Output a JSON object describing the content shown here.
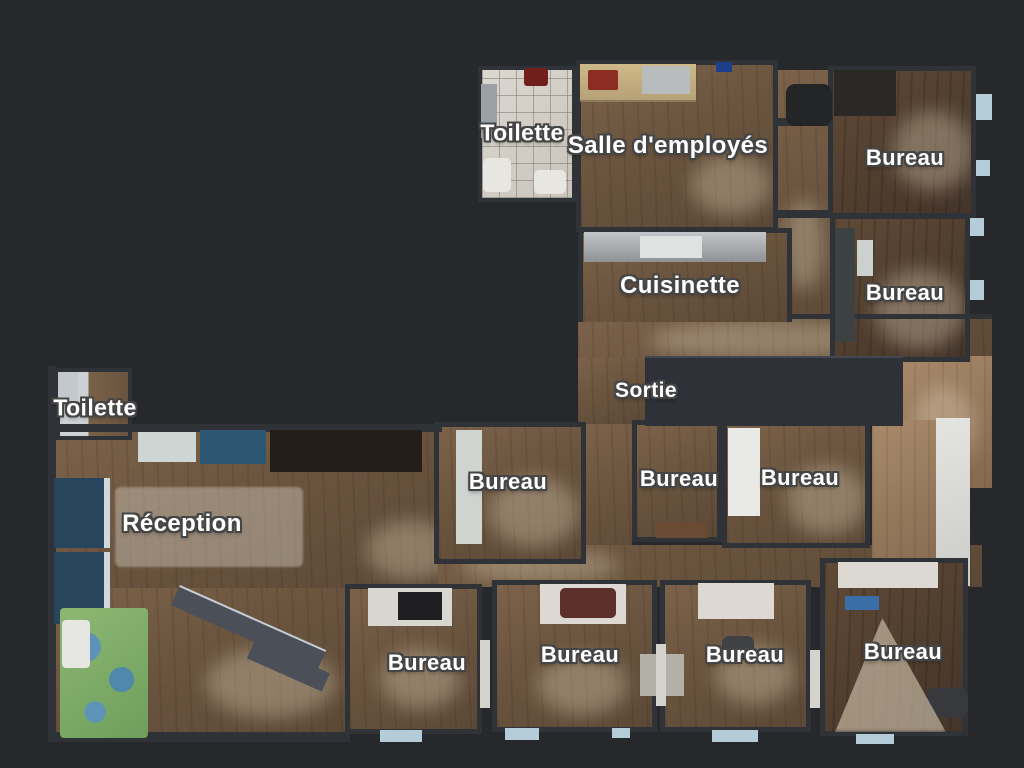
{
  "palette": {
    "background": "#26282c",
    "wall": "#2f3237",
    "wood_mid": "#6b553f",
    "wood_dark": "#4f3d2e",
    "wood_tan": "#94775b",
    "tile": "#d3cec6",
    "label_text": "#ffffff",
    "label_outline": "#454545",
    "window_sill": "#b4cbd8",
    "play_mat_green": "#7fae6a",
    "play_mat_blue": "#5d93b8"
  },
  "rooms": [
    {
      "id": "toilette-top",
      "label": "Toilette"
    },
    {
      "id": "salle-demployes",
      "label": "Salle d'employés"
    },
    {
      "id": "bureau-top-right",
      "label": "Bureau"
    },
    {
      "id": "cuisinette",
      "label": "Cuisinette"
    },
    {
      "id": "bureau-right",
      "label": "Bureau"
    },
    {
      "id": "sortie",
      "label": "Sortie"
    },
    {
      "id": "toilette-left",
      "label": "Toilette"
    },
    {
      "id": "bureau-mid-left",
      "label": "Bureau"
    },
    {
      "id": "bureau-mid-center",
      "label": "Bureau"
    },
    {
      "id": "bureau-mid-right",
      "label": "Bureau"
    },
    {
      "id": "reception",
      "label": "Réception"
    },
    {
      "id": "bureau-bottom-1",
      "label": "Bureau"
    },
    {
      "id": "bureau-bottom-2",
      "label": "Bureau"
    },
    {
      "id": "bureau-bottom-3",
      "label": "Bureau"
    },
    {
      "id": "bureau-bottom-4",
      "label": "Bureau"
    }
  ]
}
